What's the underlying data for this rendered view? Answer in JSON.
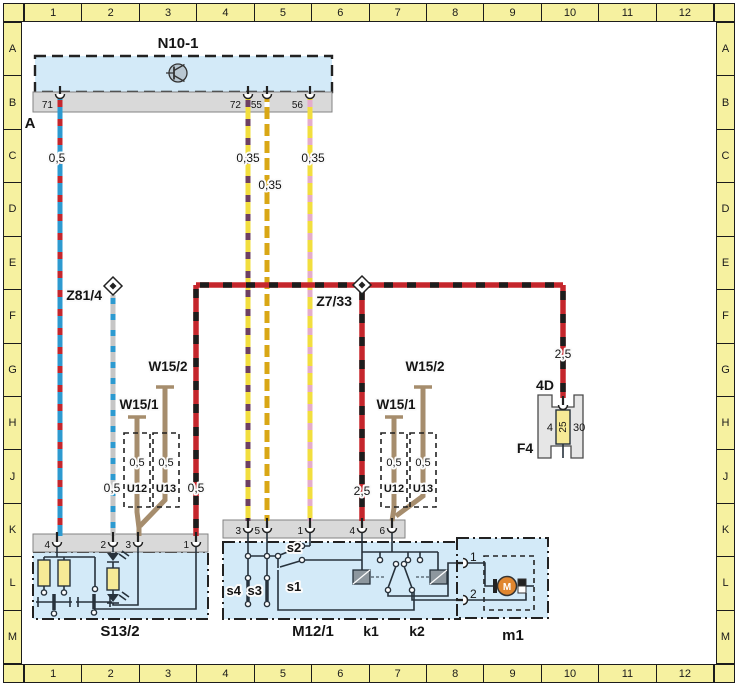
{
  "palette": {
    "frame_yellow": "#f6f1a0",
    "frame_line": "#1c1c1c",
    "unit_blue": "#d3eaf8",
    "strip_gray": "#d9d9d9",
    "wire_red": "#c5262c",
    "wire_blue": "#2d9ad0",
    "wire_black": "#1d1d1d",
    "wire_gray": "#c6c6c6",
    "wire_yellow": "#f2de3e",
    "wire_violet": "#6d4062",
    "wire_pink": "#e5accb",
    "wire_gold": "#d9a715",
    "wire_brown": "#a68d6d",
    "resistor_yellow": "#f7ea96",
    "motor_orange": "#e0862f",
    "relay_gray": "#8d979e",
    "fuse_gray": "#e6e6e6"
  },
  "grid": {
    "cols": [
      "1",
      "2",
      "3",
      "4",
      "5",
      "6",
      "7",
      "8",
      "9",
      "10",
      "11",
      "12"
    ],
    "rows": [
      "A",
      "B",
      "C",
      "D",
      "E",
      "F",
      "G",
      "H",
      "J",
      "K",
      "L",
      "M"
    ]
  },
  "n10_1": {
    "label": "N10-1",
    "connector": "A",
    "pins": {
      "p71": "71",
      "p72": "72",
      "p55": "55",
      "p56": "56"
    }
  },
  "gauges": {
    "n71": "0,5",
    "n72": "0,35",
    "n55": "0,35",
    "n56": "0,35",
    "z81": "0,5",
    "s13": "0,5",
    "m12": "2,5",
    "f4": "2,5"
  },
  "connectors": {
    "z81_4": "Z81/4",
    "z7_33": "Z7/33"
  },
  "grounds": {
    "left": {
      "w15_1": "W15/1",
      "w15_2": "W15/2",
      "u12": "U12",
      "u13": "U13",
      "size_u12": "0,5",
      "size_u13": "0,5"
    },
    "mid": {
      "w15_1": "W15/1",
      "w15_2": "W15/2",
      "u12": "U12",
      "u13": "U13",
      "size_u12": "0,5",
      "size_u13": "0,5"
    }
  },
  "f4": {
    "name": "F4",
    "grid_ref": "4D",
    "rating": "25",
    "terminal_left": "4",
    "terminal_right": "30"
  },
  "s13_2": {
    "name": "S13/2",
    "pins": {
      "p4": "4",
      "p2": "2",
      "p3": "3",
      "p1": "1"
    }
  },
  "m12_1": {
    "name": "M12/1",
    "pins": {
      "p3": "3",
      "p5": "5",
      "p1": "1",
      "p4": "4",
      "p6": "6"
    },
    "labels": {
      "s1": "s1",
      "s2": "s2",
      "s3": "s3",
      "s4": "s4",
      "k1": "k1",
      "k2": "k2"
    }
  },
  "m1": {
    "name": "m1",
    "pins": {
      "p1": "1",
      "p2": "2"
    },
    "motor": "M"
  }
}
